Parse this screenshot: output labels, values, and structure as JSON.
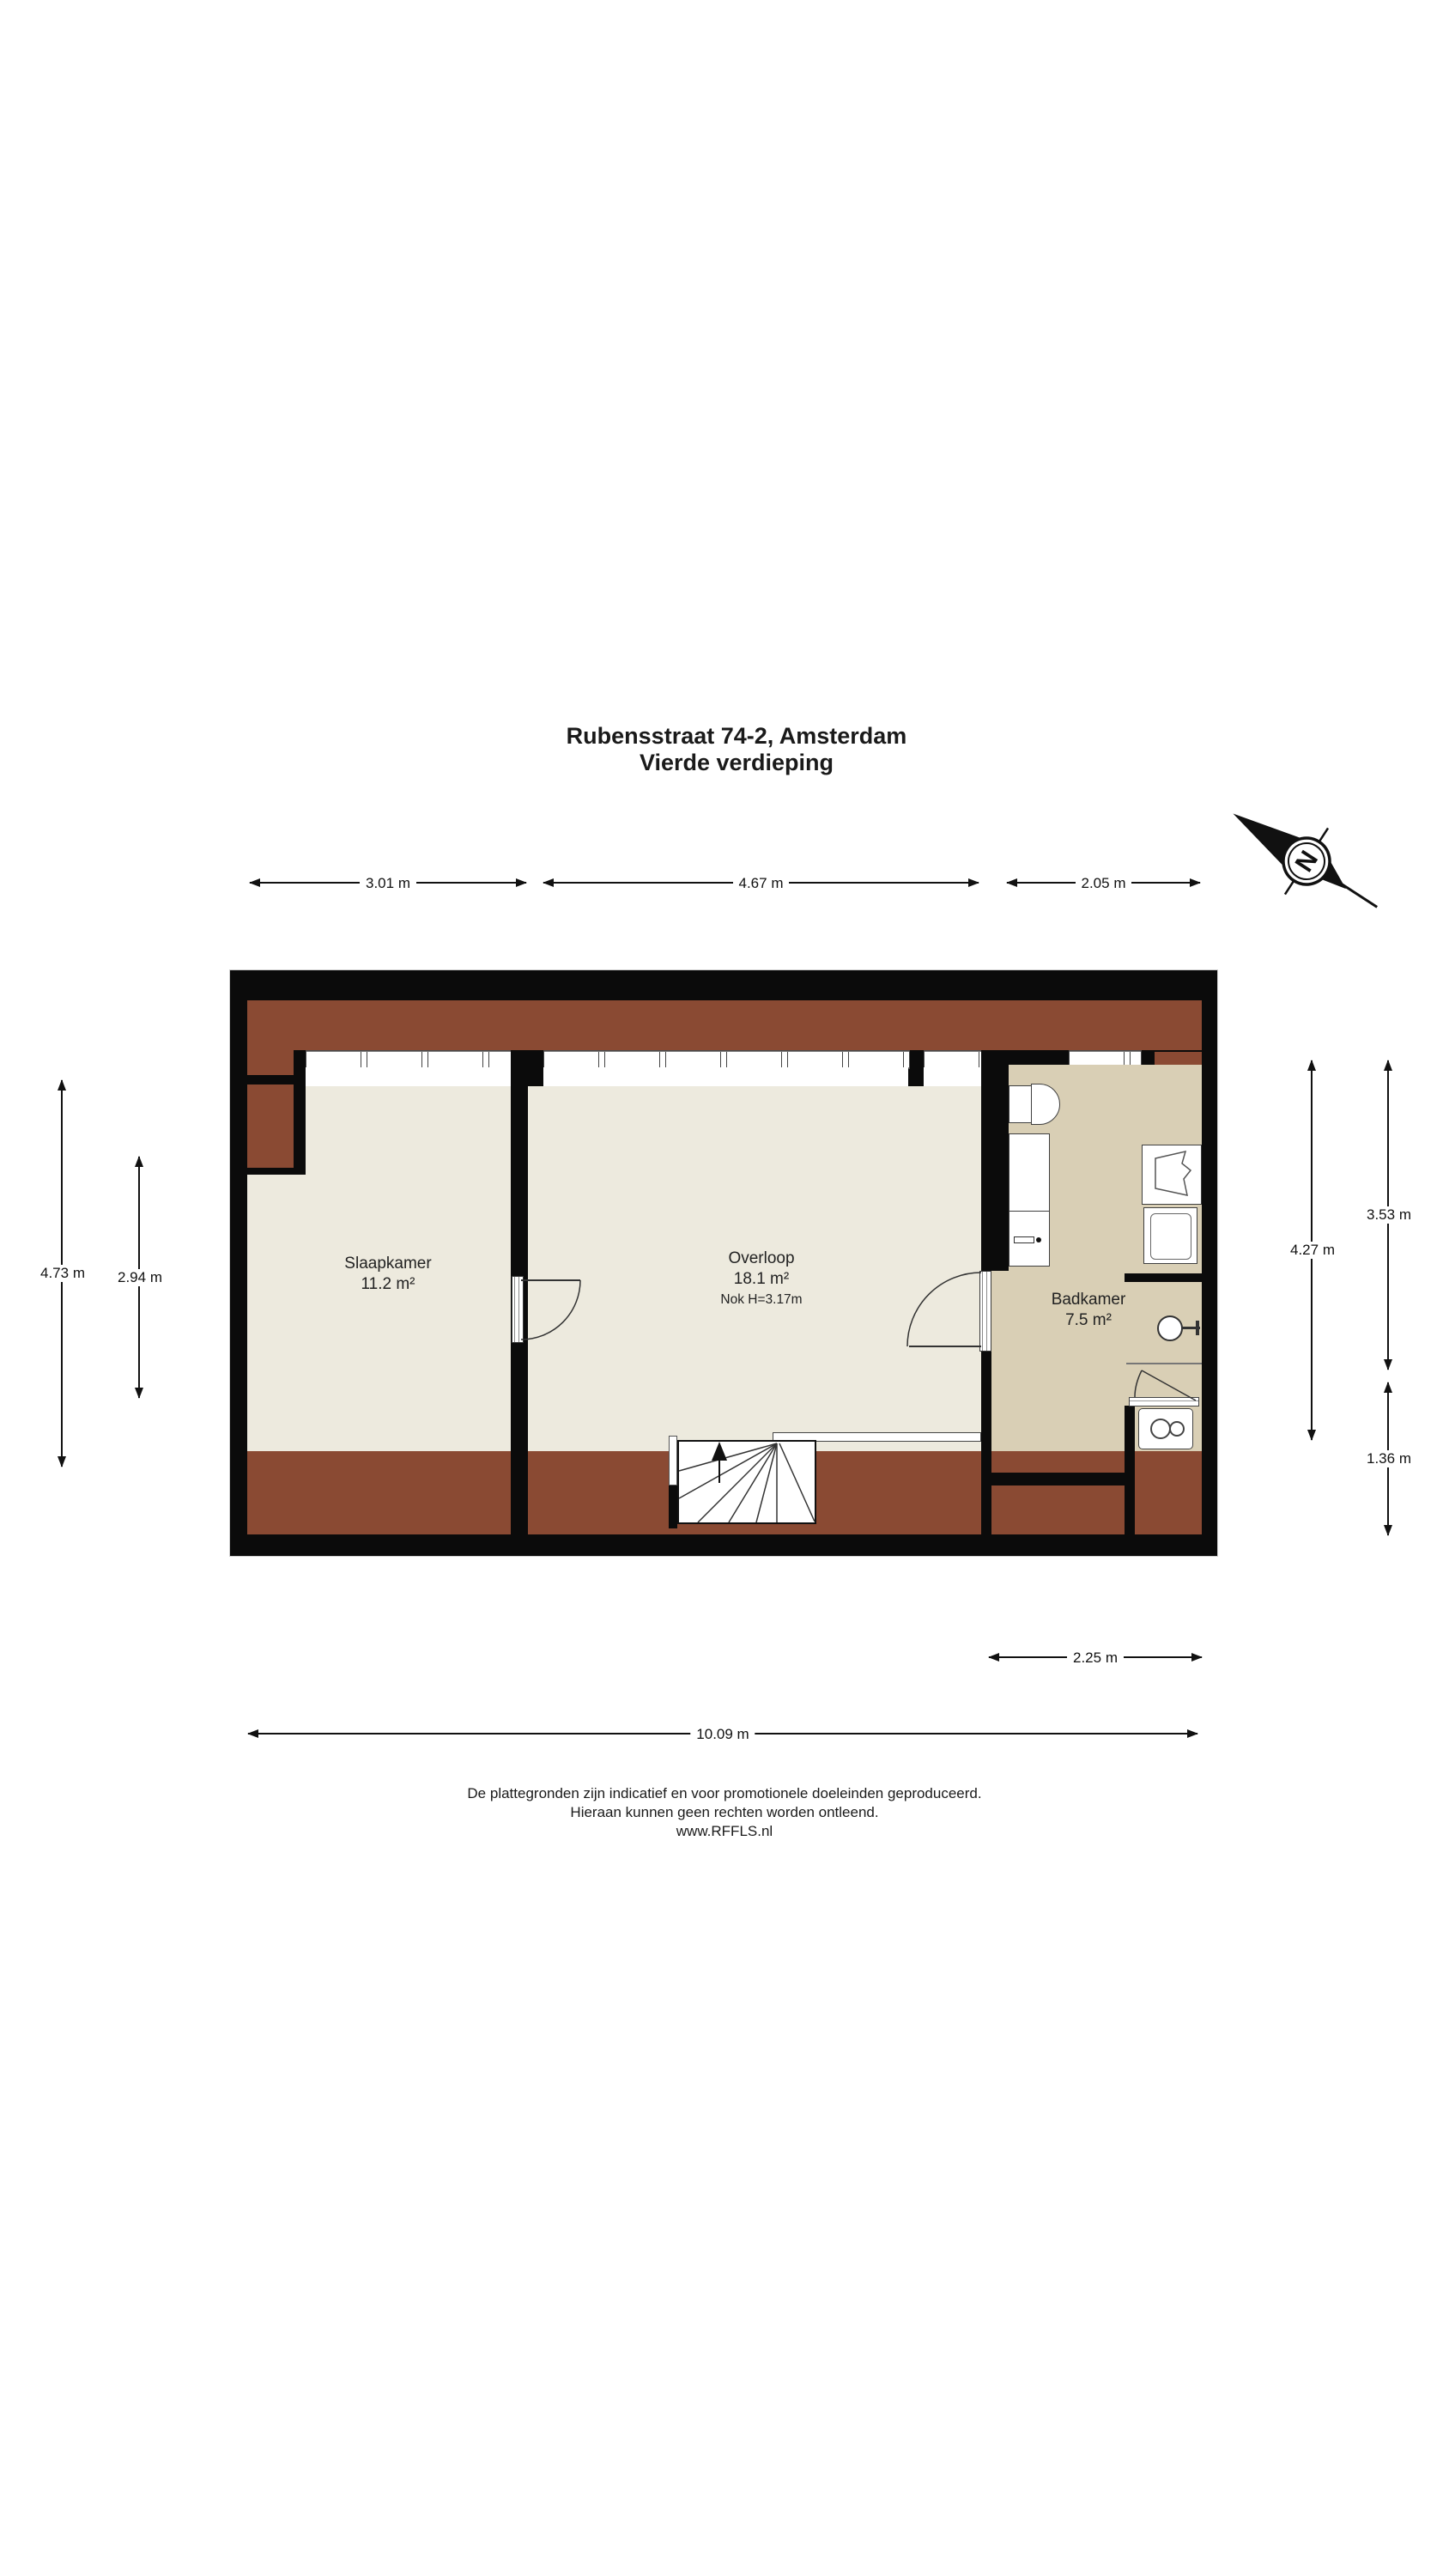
{
  "document": {
    "title_line1": "Rubensstraat 74-2, Amsterdam",
    "title_line2": "Vierde verdieping"
  },
  "compass": {
    "north_label": "N"
  },
  "rooms": {
    "slaapkamer": {
      "name": "Slaapkamer",
      "area": "11.2 m²"
    },
    "overloop": {
      "name": "Overloop",
      "area": "18.1 m²",
      "ridge_note": "Nok H=3.17m"
    },
    "badkamer": {
      "name": "Badkamer",
      "area": "7.5 m²"
    }
  },
  "dimensions": {
    "top": [
      "3.01 m",
      "4.67 m",
      "2.05 m"
    ],
    "left": [
      "4.73 m",
      "2.94 m"
    ],
    "right": [
      "4.27 m",
      "3.53 m",
      "1.36 m"
    ],
    "bottom": [
      "2.25 m",
      "10.09 m"
    ]
  },
  "footer": {
    "line1": "De plattegronden zijn indicatief en voor promotionele doeleinden geproduceerd.",
    "line2": "Hieraan kunnen geen rechten worden ontleend.",
    "line3": "www.RFFLS.nl"
  },
  "colors": {
    "wall": "#0b0b0b",
    "floor": "#edeade",
    "bathroom_floor": "#d9cfb5",
    "roof_tile": "#8a4a33",
    "roof_tile_dark": "#56281a"
  }
}
